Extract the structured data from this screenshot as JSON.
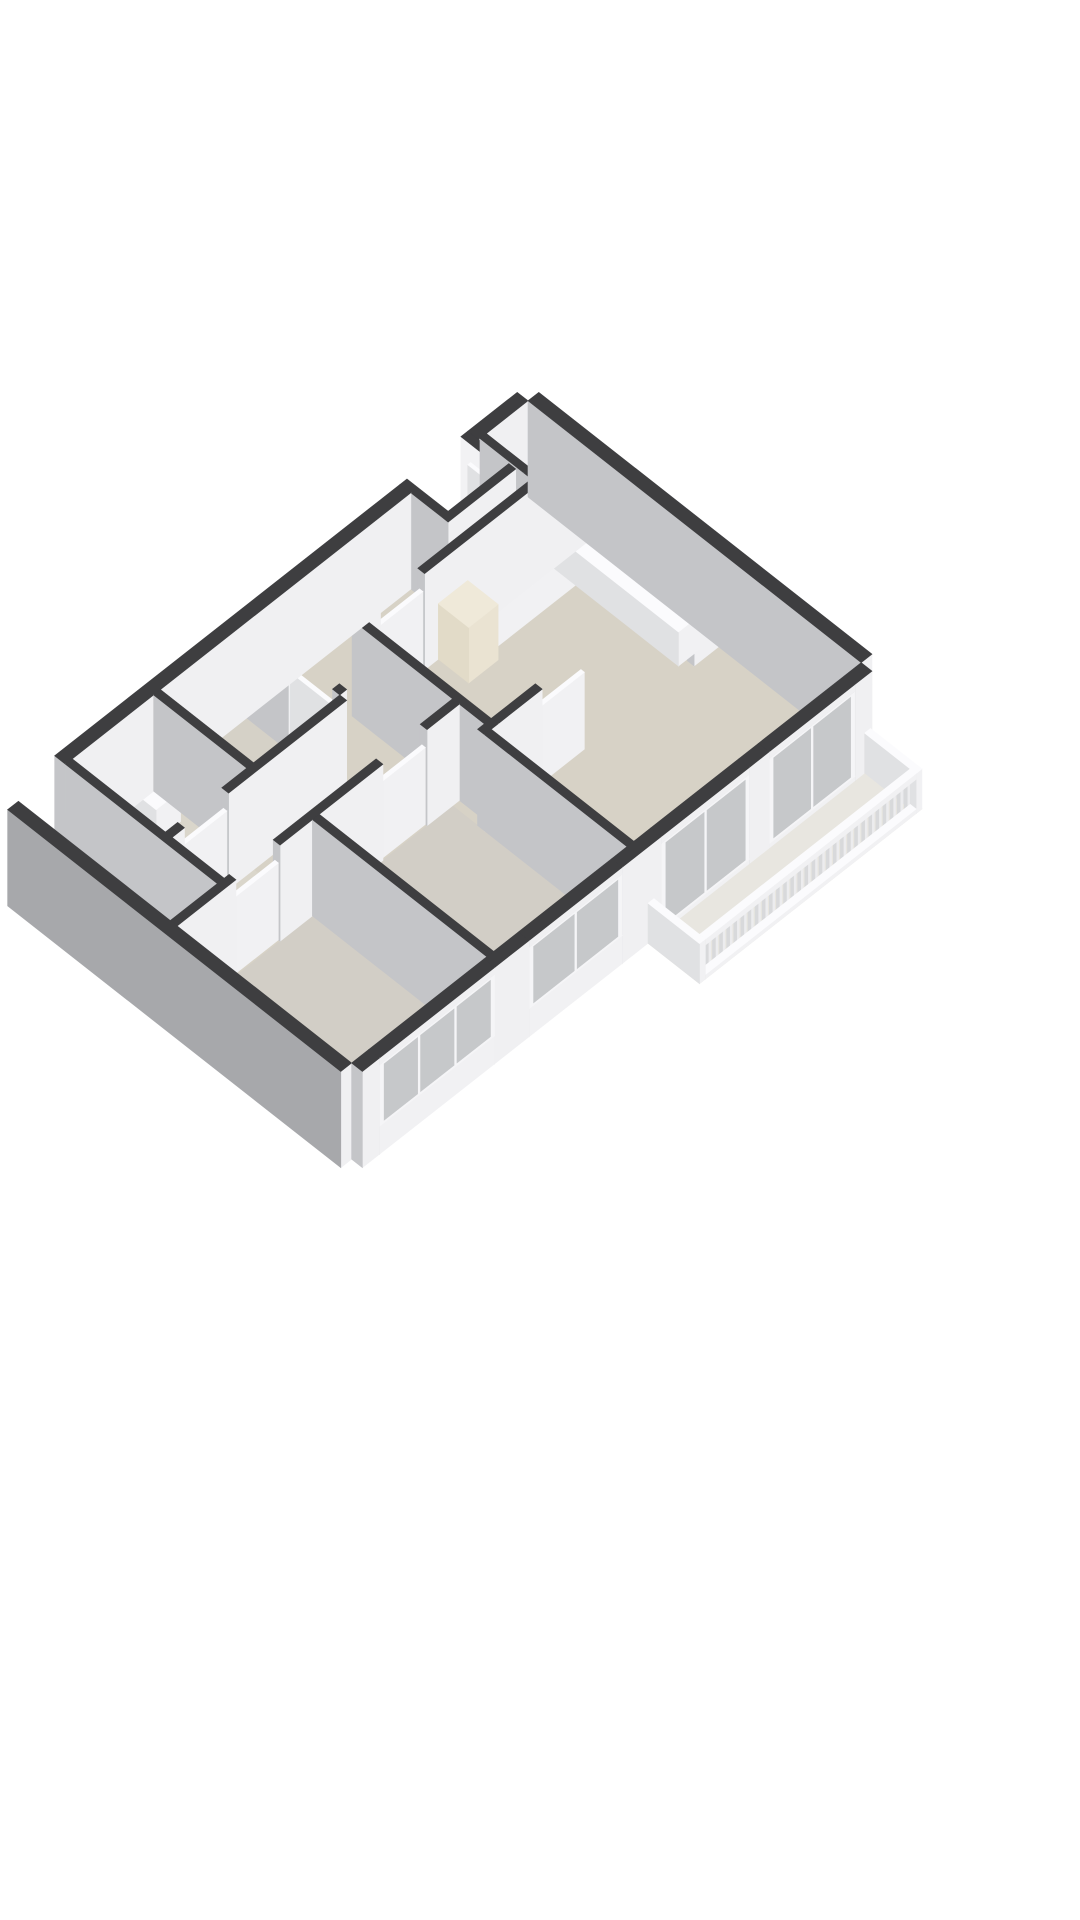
{
  "meta": {
    "type": "3d-floorplan-render",
    "background": "#ffffff",
    "view": "isometric-birdseye",
    "visible_text": ""
  },
  "scene": {
    "projection": {
      "cx": 528,
      "cy": 497,
      "ax": 49,
      "ay": 38.5,
      "az": 37
    },
    "wall_height": 2.6,
    "colors": {
      "wall_cap": "#3e3e40",
      "wall_face_x": "#f0f0f2",
      "wall_face_y": "#c4c5c8",
      "exterior_shadow_face": "#a7a8ab",
      "white_cap": "#fbfbfd",
      "white_face_x": "#f1f1f3",
      "white_face_y": "#e0e1e3",
      "glass": "#c6c8ca",
      "floor_main": "#d7d2c6",
      "floor_bedroom": "#d2cec6",
      "floor_bath": "#dad6cb",
      "floor_porch": "#c8c8c7",
      "floor_balcony": "#e8e6e0",
      "stove": "#232325",
      "burner": "#0d0d0e",
      "fridge_cap": "#efe9d9",
      "fridge_fx": "#eae3d2",
      "fridge_fy": "#e2dbc8",
      "pipe_dark": "#28282a",
      "pipe_red": "#a23d2a",
      "metal": "#97999c",
      "sink_steel": "#b4b7ba"
    },
    "floors": [
      {
        "name": "floor-apartment",
        "x": 0,
        "y": 0,
        "w": 6.8,
        "d": 10.4,
        "color": "#d7d2c6"
      },
      {
        "name": "floor-bedroom-1",
        "x": 3.24,
        "y": 4.78,
        "w": 3.56,
        "d": 2.72,
        "color": "#d2cec6"
      },
      {
        "name": "floor-bedroom-2",
        "x": 3.24,
        "y": 7.64,
        "w": 3.56,
        "d": 2.76,
        "color": "#d2cec6"
      },
      {
        "name": "floor-storage-room",
        "x": 0,
        "y": 5.74,
        "w": 1.9,
        "d": 1.76,
        "color": "#d5d1c7"
      },
      {
        "name": "floor-bathroom",
        "x": 0,
        "y": 7.64,
        "w": 3.1,
        "d": 1.66,
        "color": "#dad6cb"
      },
      {
        "name": "floor-porch",
        "x": 0,
        "y": 9.44,
        "w": 1.9,
        "d": 0.96,
        "color": "#c8c8c7"
      },
      {
        "name": "floor-closet",
        "x": 1.9,
        "y": 9.44,
        "w": 1.34,
        "d": 0.96,
        "color": "#d0cdc5"
      },
      {
        "name": "floor-entry-notch-void",
        "x": 0,
        "y": 1.15,
        "w": 0.62,
        "d": 1.1,
        "color": "#ffffff"
      },
      {
        "name": "floor-balcony",
        "x": 7.02,
        "y": 0.03,
        "w": 1.05,
        "d": 4.54,
        "color": "#e8e6e0"
      }
    ],
    "walls": [
      {
        "name": "wall-ext-ne",
        "x": 0,
        "y": -0.22,
        "w": 6.8,
        "d": 0.22
      },
      {
        "name": "wall-ext-nw-1",
        "x": -0.22,
        "y": 0,
        "w": 0.22,
        "d": 1.01
      },
      {
        "name": "wall-entry-notch-a",
        "x": -0.22,
        "y": 1.01,
        "w": 0.84,
        "d": 0.14,
        "fy": "#f2f2f4"
      },
      {
        "name": "wall-entry-notch-b",
        "x": -0.22,
        "y": 2.25,
        "w": 0.84,
        "d": 0.14
      },
      {
        "name": "wall-entry-notch-c",
        "x": 0.62,
        "y": 1.01,
        "w": 0.14,
        "d": 1.38
      },
      {
        "name": "wall-ext-nw-2",
        "x": -0.22,
        "y": 2.39,
        "w": 0.22,
        "d": 7.05
      },
      {
        "name": "wall-ext-sw",
        "x": 0,
        "y": 10.4,
        "w": 6.8,
        "d": 0.22,
        "fy": "#a7a8ab"
      },
      {
        "name": "wall-ext-se-stub-1",
        "x": 6.8,
        "y": 0,
        "w": 0.22,
        "d": 0.35
      },
      {
        "name": "wall-ext-se-stub-2",
        "x": 6.8,
        "y": 2.1,
        "w": 0.22,
        "d": 0.4
      },
      {
        "name": "wall-ext-se-stub-3",
        "x": 6.8,
        "y": 4.3,
        "w": 0.22,
        "d": 0.8
      },
      {
        "name": "wall-ext-se-stub-4",
        "x": 6.8,
        "y": 7.0,
        "w": 0.22,
        "d": 0.7
      },
      {
        "name": "wall-ext-se-stub-5",
        "x": 6.8,
        "y": 10.05,
        "w": 0.22,
        "d": 0.35
      },
      {
        "name": "wall-meter-closet-a",
        "x": 0,
        "y": 0.85,
        "w": 0.9,
        "d": 0.13
      },
      {
        "name": "wall-meter-closet-b",
        "x": 0.9,
        "y": 0,
        "w": 0.13,
        "d": 0.98
      },
      {
        "name": "wall-hall-kitchen-1",
        "x": 1.05,
        "y": 0,
        "w": 0.14,
        "d": 3.3
      },
      {
        "name": "wall-hall-kitchen-2",
        "x": 1.05,
        "y": 4.2,
        "w": 0.14,
        "d": 0.3
      },
      {
        "name": "wall-kitchen-sw-1",
        "x": 1.05,
        "y": 4.5,
        "w": 2.84,
        "d": 0.14
      },
      {
        "name": "wall-kitchen-sw-2",
        "x": 3.75,
        "y": 4.5,
        "w": 0.14,
        "d": 0.28
      },
      {
        "name": "wall-kitchen-living-1",
        "x": 3.75,
        "y": 0,
        "w": 0.14,
        "d": 0.5
      },
      {
        "name": "wall-kitchen-living-2",
        "x": 3.75,
        "y": 3.6,
        "w": 0.14,
        "d": 0.9
      },
      {
        "name": "wall-living-sw",
        "x": 3.89,
        "y": 4.64,
        "w": 2.91,
        "d": 0.14
      },
      {
        "name": "wall-landing-south-1",
        "x": 0,
        "y": 5.6,
        "w": 0.85,
        "d": 0.14
      },
      {
        "name": "wall-landing-south-2",
        "x": 1.75,
        "y": 5.6,
        "w": 0.15,
        "d": 0.14
      },
      {
        "name": "wall-corridor-west-1",
        "x": 1.9,
        "y": 5.74,
        "w": 0.14,
        "d": 2.41
      },
      {
        "name": "wall-corridor-west-2",
        "x": 1.9,
        "y": 9.05,
        "w": 0.14,
        "d": 0.25
      },
      {
        "name": "wall-storage-bath",
        "x": 0,
        "y": 7.5,
        "w": 1.9,
        "d": 0.14
      },
      {
        "name": "wall-bath-south",
        "x": 0,
        "y": 9.3,
        "w": 3.24,
        "d": 0.14
      },
      {
        "name": "wall-corridor-east-1",
        "x": 3.1,
        "y": 4.64,
        "w": 0.14,
        "d": 0.66
      },
      {
        "name": "wall-corridor-east-2",
        "x": 3.1,
        "y": 6.2,
        "w": 0.14,
        "d": 2.1
      },
      {
        "name": "wall-corridor-east-3",
        "x": 3.1,
        "y": 9.2,
        "w": 0.14,
        "d": 1.2
      },
      {
        "name": "wall-bedroom-divider",
        "x": 3.24,
        "y": 7.5,
        "w": 3.56,
        "d": 0.14
      },
      {
        "name": "wall-porch-closet",
        "x": 1.9,
        "y": 9.44,
        "w": 0.14,
        "d": 0.96
      }
    ],
    "doors": [
      {
        "name": "front-door",
        "x": 0.0,
        "y": 1.17,
        "w": 0.56,
        "d": 0.06,
        "h": 2.15
      },
      {
        "name": "door-hall-kitchen",
        "x": 1.085,
        "y": 3.3,
        "w": 0.07,
        "d": 0.9,
        "h": 2.08
      },
      {
        "name": "door-living",
        "x": 3.78,
        "y": 2.7,
        "w": 0.07,
        "d": 0.9,
        "h": 2.08
      },
      {
        "name": "door-storage-room",
        "x": 0.85,
        "y": 5.63,
        "w": 0.9,
        "d": 0.07,
        "h": 2.08
      },
      {
        "name": "door-bathroom",
        "x": 1.935,
        "y": 8.15,
        "w": 0.07,
        "d": 0.9,
        "h": 2.08
      },
      {
        "name": "door-bedroom-1",
        "x": 3.135,
        "y": 5.3,
        "w": 0.07,
        "d": 0.9,
        "h": 2.08
      },
      {
        "name": "door-bedroom-2",
        "x": 3.135,
        "y": 8.3,
        "w": 0.07,
        "d": 0.9,
        "h": 2.08
      }
    ],
    "windows": [
      {
        "name": "balcony-door-glass",
        "x": 6.8,
        "y": 0.35,
        "w": 0.22,
        "d": 1.75,
        "sill": 0.12,
        "top": 2.42,
        "panes": 2
      },
      {
        "name": "living-window",
        "x": 6.8,
        "y": 2.5,
        "w": 0.22,
        "d": 1.8,
        "sill": 0.12,
        "top": 2.42,
        "panes": 2
      },
      {
        "name": "bedroom-1-window",
        "x": 6.8,
        "y": 5.1,
        "w": 0.22,
        "d": 1.9,
        "sill": 0.76,
        "top": 2.42,
        "panes": 2
      },
      {
        "name": "bedroom-2-window",
        "x": 6.8,
        "y": 7.7,
        "w": 0.22,
        "d": 2.35,
        "sill": 0.76,
        "top": 2.42,
        "panes": 3
      }
    ],
    "railing": {
      "name": "balcony-railing",
      "x": 7.95,
      "y0": 0.15,
      "y1": 4.45,
      "rail_w": 0.12,
      "post_w": 0.06,
      "post_step": 0.145,
      "top_z": 0.92,
      "top_h": 0.16,
      "bottom_h": 0.12
    },
    "fixtures": [
      {
        "name": "balcony-rail-end-sw",
        "x": 7.02,
        "y": 4.45,
        "w": 1.05,
        "d": 0.12,
        "h": 1.08,
        "kind": "white"
      },
      {
        "name": "balcony-rail-end-ne",
        "x": 7.02,
        "y": 0.03,
        "w": 1.05,
        "d": 0.12,
        "h": 1.08,
        "kind": "white"
      },
      {
        "name": "kitchen-counter-sink-run",
        "x": 1.19,
        "y": 0.22,
        "w": 2.54,
        "d": 0.44,
        "h": 0.92,
        "kind": "white"
      },
      {
        "name": "kitchen-counter-stove-run",
        "x": 1.19,
        "y": 0.22,
        "w": 0.44,
        "d": 2.2,
        "h": 0.92,
        "kind": "white"
      },
      {
        "name": "kitchen-stove",
        "x": 1.2,
        "y": 1.2,
        "w": 0.42,
        "d": 0.78,
        "h": 0.94,
        "kind": "stove"
      },
      {
        "name": "kitchen-fridge",
        "x": 1.19,
        "y": 2.42,
        "w": 0.62,
        "d": 0.6,
        "h": 1.5,
        "kind": "fridge"
      },
      {
        "name": "kitchen-faucet",
        "x": 2.77,
        "y": 0.26,
        "w": 0.055,
        "d": 0.055,
        "h": 1.15,
        "kind": "metal"
      },
      {
        "name": "bathtub",
        "x": 0.15,
        "y": 8.35,
        "w": 1.5,
        "d": 0.8,
        "h": 0.58,
        "kind": "white"
      },
      {
        "name": "bathtub-faucet",
        "x": 1.45,
        "y": 8.4,
        "w": 0.05,
        "d": 0.05,
        "h": 0.95,
        "kind": "metal"
      },
      {
        "name": "bathroom-basin",
        "x": 0.12,
        "y": 7.76,
        "w": 0.55,
        "d": 0.5,
        "h": 0.84,
        "kind": "white"
      },
      {
        "name": "toilet-bowl-box",
        "x": 2.5,
        "y": 8.86,
        "w": 0.4,
        "d": 0.3,
        "h": 0.4,
        "kind": "white"
      },
      {
        "name": "toilet-cistern",
        "x": 2.5,
        "y": 9.16,
        "w": 0.4,
        "d": 0.13,
        "h": 0.72,
        "kind": "white"
      },
      {
        "name": "porch-radiator",
        "x": 0.08,
        "y": 9.86,
        "w": 0.3,
        "d": 0.4,
        "h": 0.5,
        "kind": "white"
      },
      {
        "name": "meter-pipe-1",
        "x": 0.16,
        "y": 0.08,
        "w": 0.09,
        "d": 0.09,
        "h": 2.3,
        "kind": "pipe"
      },
      {
        "name": "meter-pipe-2",
        "x": 0.34,
        "y": 0.08,
        "w": 0.09,
        "d": 0.09,
        "h": 2.3,
        "kind": "pipe"
      },
      {
        "name": "meter-pipe-3",
        "x": 0.52,
        "y": 0.08,
        "w": 0.09,
        "d": 0.09,
        "h": 2.3,
        "kind": "pipe"
      },
      {
        "name": "meter-pipe-red",
        "x": 0.72,
        "y": 0.1,
        "w": 0.08,
        "d": 0.08,
        "h": 2.25,
        "kind": "redpipe"
      }
    ],
    "deco": [
      {
        "name": "sink-basin",
        "type": "rect",
        "x": 2.55,
        "y": 0.34,
        "w": 0.5,
        "d": 0.34,
        "z": 0.925,
        "fill": "#b4b7ba"
      },
      {
        "name": "sink-basin-inner",
        "type": "rect",
        "x": 2.61,
        "y": 0.4,
        "w": 0.38,
        "d": 0.22,
        "z": 0.927,
        "fill": "#d6d9db"
      },
      {
        "name": "stove-burner-1",
        "type": "ellipse",
        "cx": 1.31,
        "cy": 1.4,
        "rx": 0.09,
        "ry": 0.09,
        "z": 0.945,
        "fill": "#0d0d0e"
      },
      {
        "name": "stove-burner-2",
        "type": "ellipse",
        "cx": 1.51,
        "cy": 1.4,
        "rx": 0.09,
        "ry": 0.09,
        "z": 0.945,
        "fill": "#0d0d0e"
      },
      {
        "name": "stove-burner-3",
        "type": "ellipse",
        "cx": 1.31,
        "cy": 1.78,
        "rx": 0.09,
        "ry": 0.09,
        "z": 0.945,
        "fill": "#0d0d0e"
      },
      {
        "name": "stove-burner-4",
        "type": "ellipse",
        "cx": 1.51,
        "cy": 1.78,
        "rx": 0.09,
        "ry": 0.09,
        "z": 0.945,
        "fill": "#0d0d0e"
      },
      {
        "name": "bathtub-inner",
        "type": "rect",
        "x": 0.27,
        "y": 8.47,
        "w": 1.26,
        "d": 0.56,
        "z": 0.585,
        "fill": "#e9ebed"
      },
      {
        "name": "basin-inner",
        "type": "rect",
        "x": 0.2,
        "y": 7.84,
        "w": 0.39,
        "d": 0.34,
        "z": 0.845,
        "fill": "#c6c9cb"
      },
      {
        "name": "toilet-seat",
        "type": "ellipse",
        "cx": 2.7,
        "cy": 9.0,
        "rx": 0.17,
        "ry": 0.14,
        "z": 0.405,
        "fill": "#f2f3f4"
      },
      {
        "name": "toilet-seat-inner",
        "type": "ellipse",
        "cx": 2.7,
        "cy": 9.0,
        "rx": 0.1,
        "ry": 0.08,
        "z": 0.407,
        "fill": "#d3d6d8"
      }
    ]
  }
}
